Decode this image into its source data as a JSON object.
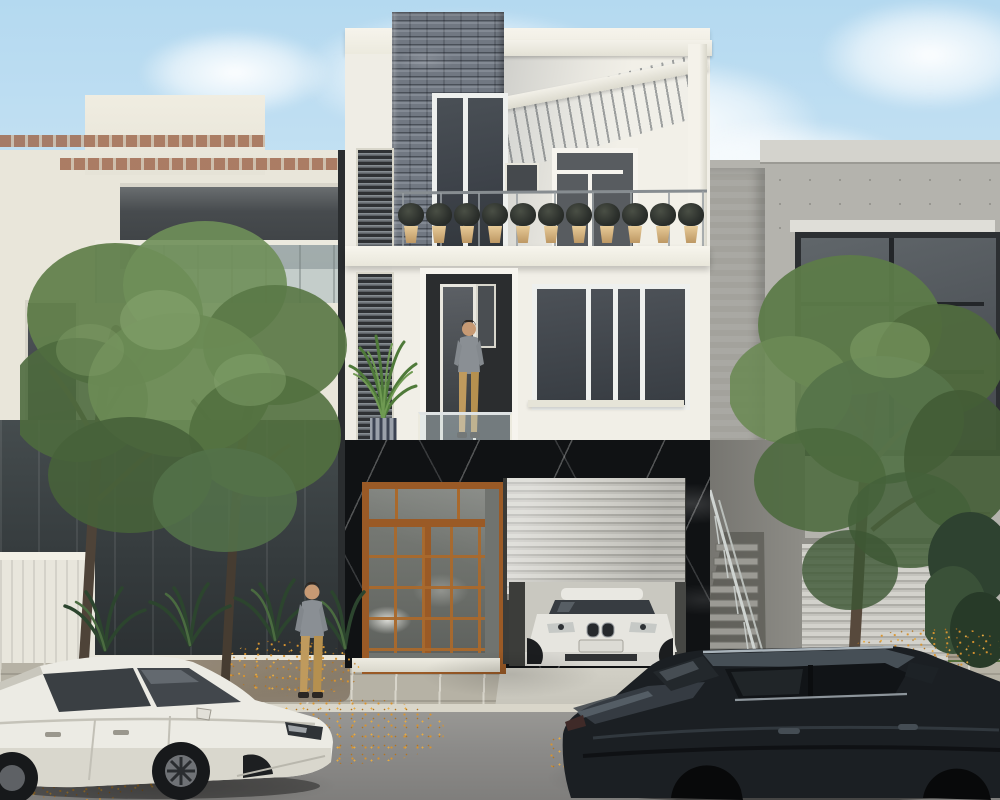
{
  "meta": {
    "title": "Modern three-storey townhouse — exterior architectural render"
  },
  "scene": {
    "description": "Photorealistic daytime architectural rendering of a narrow modern three-storey townhouse on a residential street: slate-stone and white facade, rooftop pergola terrace with a row of potted plants, second-floor balcony with a man standing at the door, black marble ground floor with an orange wood-framed glass entry and a half-open roller garage revealing a white BMW sedan; neighbouring cream and grey concrete houses, street trees with autumn leaves on the pavement, a white sedan parked at left, a dark sedan in the right foreground and a pedestrian on the sidewalk.",
    "sky": "light blue with soft white clouds",
    "main_house": {
      "floors": 3,
      "top_floor": [
        "slate stone feature wall",
        "tall dark window",
        "white pergola with louvred canopy",
        "terrace door",
        "metal railing",
        "row of planters"
      ],
      "middle_floor": [
        "white render wall",
        "louvred slat panel",
        "areca palm in striped pot",
        "recessed balcony door with man",
        "glass balustrade",
        "four-pane dark window"
      ],
      "ground_floor": [
        "black marble cladding",
        "orange timber glazed double door",
        "grey roller shutter garage",
        "white BMW sedan inside garage",
        "entry step"
      ]
    },
    "left_building": [
      "cream facade",
      "brick trim bands",
      "balcony with glass rail",
      "dark glazed lower floor",
      "white slat fence"
    ],
    "right_building": [
      "grey concrete facade",
      "large dark-framed window",
      "horizontal slat garage door",
      "stone pillar",
      "external metal stair"
    ],
    "street": [
      "paver sidewalk",
      "grey asphalt road",
      "scattered autumn leaves",
      "grass verge"
    ],
    "vehicles": {
      "left": "white sedan, parked facing right",
      "right": "dark navy sedan, rear three-quarter view",
      "garage": "white BMW sedan behind roller shutter"
    },
    "people": {
      "sidewalk_man": "grey t-shirt, khaki trousers",
      "balcony_man": "grey t-shirt, khaki trousers"
    },
    "counts": {
      "balcony_planters": 11,
      "street_cars": 2,
      "people": 2,
      "trees": 3
    }
  },
  "palette": {
    "sky_top": "#b4d9f0",
    "sky_horizon": "#e8f2f7",
    "cloud": "#ffffff",
    "house_white": "#f2f0e8",
    "stone_grey": "#79808a",
    "marble_black": "#101214",
    "timber_orange": "#9a5a26",
    "shutter_grey": "#c4c3bd",
    "louver_dark": "#2e3134",
    "left_building_cream": "#e9e6da",
    "brick_trim": "#a06a4f",
    "right_building_grey": "#b4b3ad",
    "window_glass_dark": "#3e434a",
    "road_grey": "#8b8a88",
    "paver_tan": "#b6b2a5",
    "foliage_green": "#63814d",
    "foliage_dark": "#3c5230",
    "trunk_brown": "#4e4338",
    "leaf_orange": "#d9942f",
    "white_car": "#ecebe4",
    "dark_car": "#1b1f23",
    "grass_green": "#637d45",
    "pot_tan": "#d8b98c",
    "skin": "#c79a74",
    "shirt_grey": "#8a8f94",
    "pants_khaki": "#bf9a5d"
  }
}
